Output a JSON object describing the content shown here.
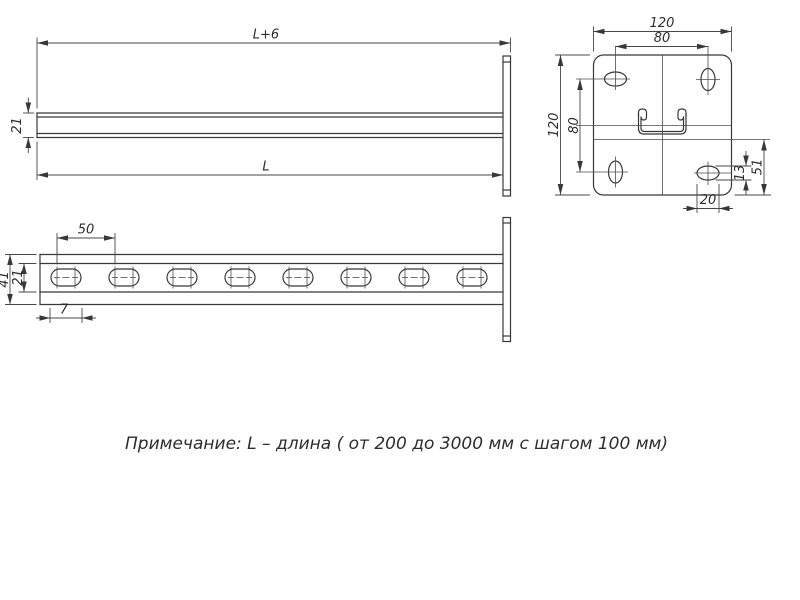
{
  "drawing": {
    "title_note": "Примечание: L – длина ( от 200 до 3000 мм с шагом 100 мм)",
    "line_color": "#383838",
    "background": "#ffffff",
    "views": {
      "side": {
        "dims": {
          "overall_length": "L+6",
          "profile_height": "21",
          "length": "L"
        }
      },
      "plan": {
        "dims": {
          "slot_pitch": "50",
          "slot_offset": "7",
          "profile_width": "41",
          "channel_width": "21"
        }
      },
      "end_plate": {
        "dims": {
          "plate_width": "120",
          "hole_pitch_horizontal": "80",
          "plate_height": "120",
          "hole_pitch_vertical": "80",
          "center_to_edge": "51",
          "hole_width": "13",
          "hole_length": "20"
        }
      }
    }
  }
}
